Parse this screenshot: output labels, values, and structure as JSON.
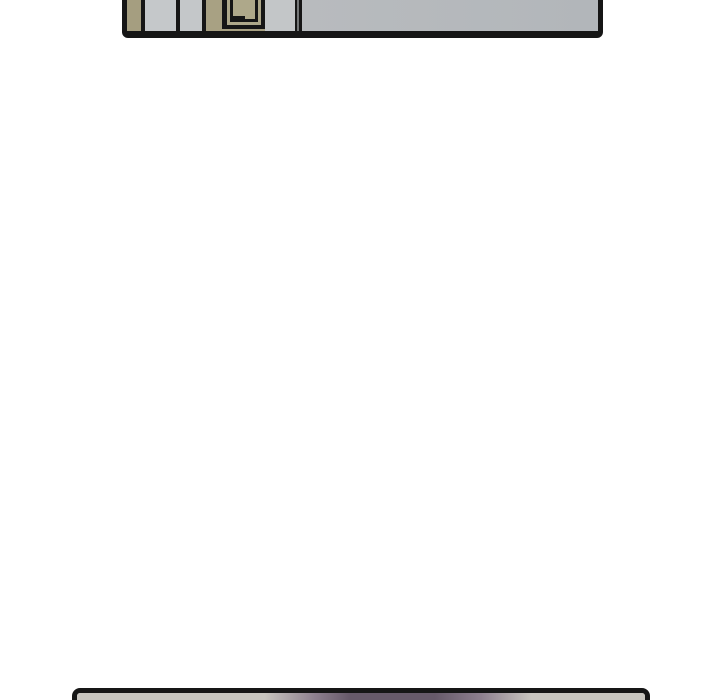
{
  "page": {
    "kind": "webtoon-comic-scroll-segment",
    "description": "White gutter between two comic panels: bottom edge of an interior-wall panel at top, top edge of a gray panel with blurred purple figure at bottom",
    "visible_text": ""
  },
  "theme": {
    "--page-bg": "#ffffff",
    "--ink": "#161616",
    "--side-tan": "#a59e80",
    "--stripe-gray1": "#c5c8ca",
    "--stripe-gray2": "#c4c7c9",
    "--cabinet-tan": "#a8a183",
    "--door-tan": "#aea88a",
    "--gap-gray": "#c3c6c8",
    "--wall-gray": "#b8bbbe",
    "--wall-gray-right": "#b2b6ba",
    "--next-base": "#c8c5bf",
    "--next-soft": "#8d7f8e",
    "--next-purple": "#675a6a"
  },
  "top_panel": {
    "content": "bottom sliver of panel showing tan cabinet strip, two light-gray wall strips, tan cabinet column with outlined door, wall corner line, plain gray wall",
    "border_color": "#161616"
  },
  "bottom_panel": {
    "content": "top sliver of next panel: light gray background with horizontally blurred purple shape in the center",
    "border_color": "#161616"
  }
}
